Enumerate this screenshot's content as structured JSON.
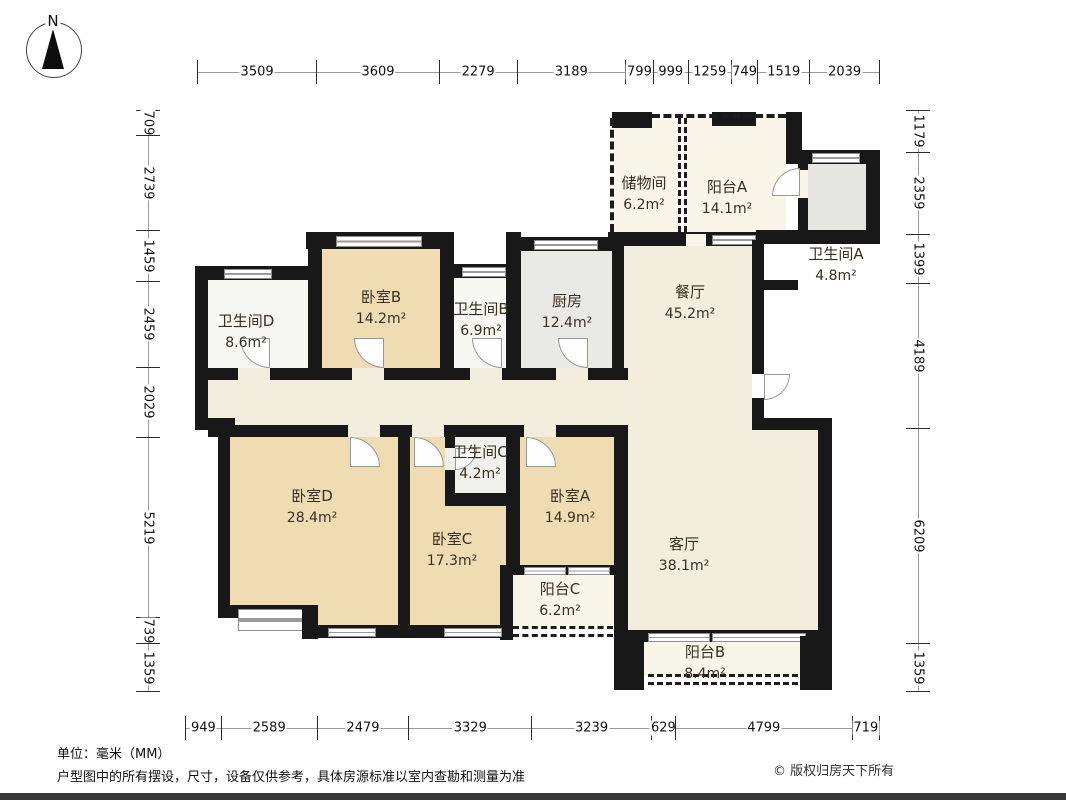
{
  "compass": {
    "label": "N"
  },
  "rulers": {
    "top": [
      "3509",
      "3609",
      "2279",
      "3189",
      "799",
      "999",
      "1259",
      "749",
      "1519",
      "2039"
    ],
    "bottom": [
      "949",
      "2589",
      "2479",
      "3329",
      "3239",
      "629",
      "4799",
      "719"
    ],
    "left": [
      "709",
      "2739",
      "1459",
      "2459",
      "2029",
      "5219",
      "739",
      "1359"
    ],
    "right": [
      "1179",
      "2359",
      "1399",
      "4189",
      "6209",
      "1359"
    ]
  },
  "rooms": {
    "storage": {
      "name": "储物间",
      "area": "6.2m²"
    },
    "balcony_a": {
      "name": "阳台A",
      "area": "14.1m²"
    },
    "bath_a": {
      "name": "卫生间A",
      "area": "4.8m²"
    },
    "bath_d": {
      "name": "卫生间D",
      "area": "8.6m²"
    },
    "bed_b": {
      "name": "卧室B",
      "area": "14.2m²"
    },
    "bath_b": {
      "name": "卫生间B",
      "area": "6.9m²"
    },
    "kitchen": {
      "name": "厨房",
      "area": "12.4m²"
    },
    "dining": {
      "name": "餐厅",
      "area": "45.2m²"
    },
    "bed_d": {
      "name": "卧室D",
      "area": "28.4m²"
    },
    "bath_c": {
      "name": "卫生间C",
      "area": "4.2m²"
    },
    "bed_c": {
      "name": "卧室C",
      "area": "17.3m²"
    },
    "bed_a": {
      "name": "卧室A",
      "area": "14.9m²"
    },
    "living": {
      "name": "客厅",
      "area": "38.1m²"
    },
    "balcony_c": {
      "name": "阳台C",
      "area": "6.2m²"
    },
    "balcony_b": {
      "name": "阳台B",
      "area": "8.4m²"
    }
  },
  "footer": {
    "unit_note": "单位：毫米（MM）",
    "disclaimer": "户型图中的所有摆设，尺寸，设备仅供参考，具体房源标准以室内查勘和测量为准",
    "copyright": "© 版权归房天下所有"
  },
  "colors": {
    "wall": "#181818",
    "bedroom_fill": "#EFDCB3",
    "living_fill": "#F3EDDE",
    "balcony_fill": "#FAF5E9",
    "bath_fill": "#F7F7F4",
    "kitchen_fill": "#E9E9E6",
    "bath_gray_fill": "#E6E6E3"
  }
}
